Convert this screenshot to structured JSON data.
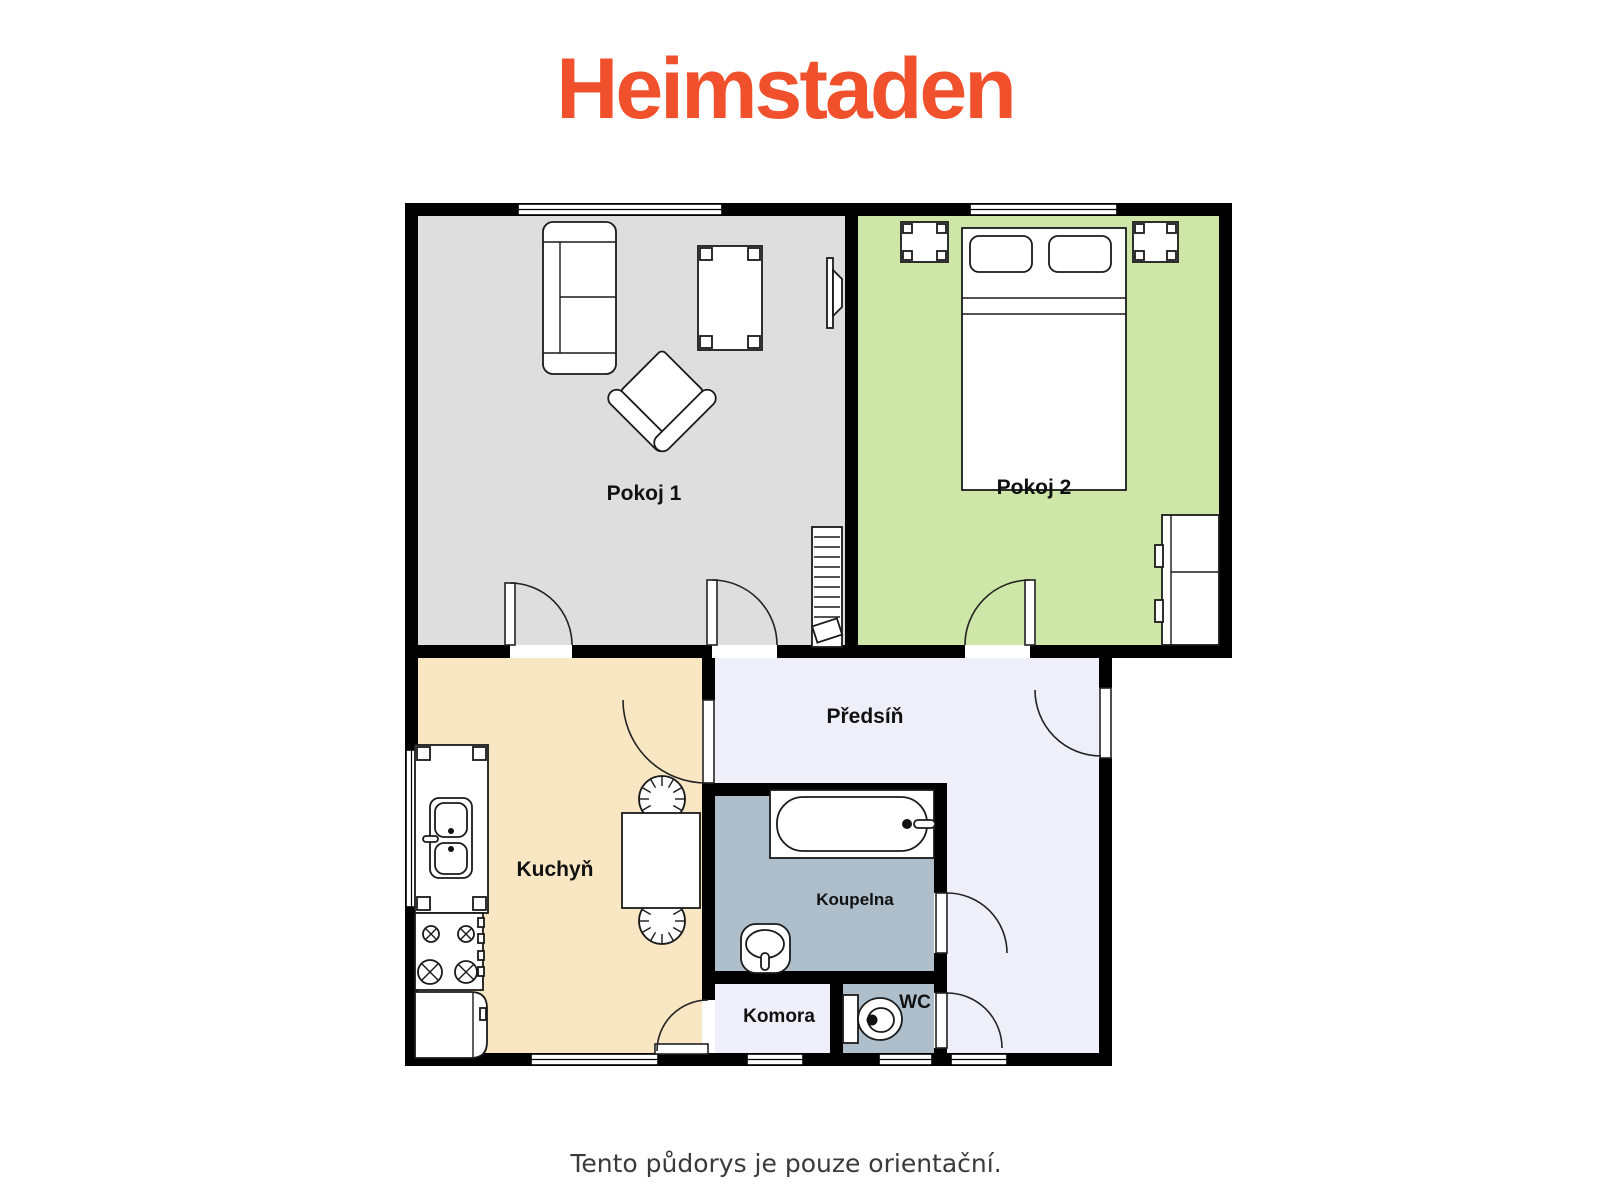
{
  "brand": {
    "logo_text": "Heimstaden",
    "logo_color": "#F1502C"
  },
  "footer": {
    "disclaimer": "Tento půdorys je pouze orientační.",
    "text_color": "#3A3A3A"
  },
  "floor_plan": {
    "wall_color": "#000000",
    "rooms": [
      {
        "id": "pokoj1",
        "label": "Pokoj 1",
        "color": "#DEDEDE"
      },
      {
        "id": "pokoj2",
        "label": "Pokoj 2",
        "color": "#CEE6A7"
      },
      {
        "id": "kuchyn",
        "label": "Kuchyň",
        "color": "#F9E7C4"
      },
      {
        "id": "predsin",
        "label": "Předsíň",
        "color": "#EFEFFA"
      },
      {
        "id": "koupelna",
        "label": "Koupelna",
        "color": "#AEBECB"
      },
      {
        "id": "komora",
        "label": "Komora",
        "color": "#EFEFFA"
      },
      {
        "id": "wc",
        "label": "WC",
        "color": "#AEBECB"
      }
    ],
    "furniture": [
      "sofa",
      "coffee-table",
      "armchair",
      "tv",
      "radiator",
      "double-bed",
      "nightstand-left",
      "nightstand-right",
      "wardrobe",
      "kitchen-counter",
      "sink",
      "stove",
      "fridge",
      "dining-table",
      "stool",
      "bathtub",
      "washbasin",
      "toilet"
    ]
  }
}
